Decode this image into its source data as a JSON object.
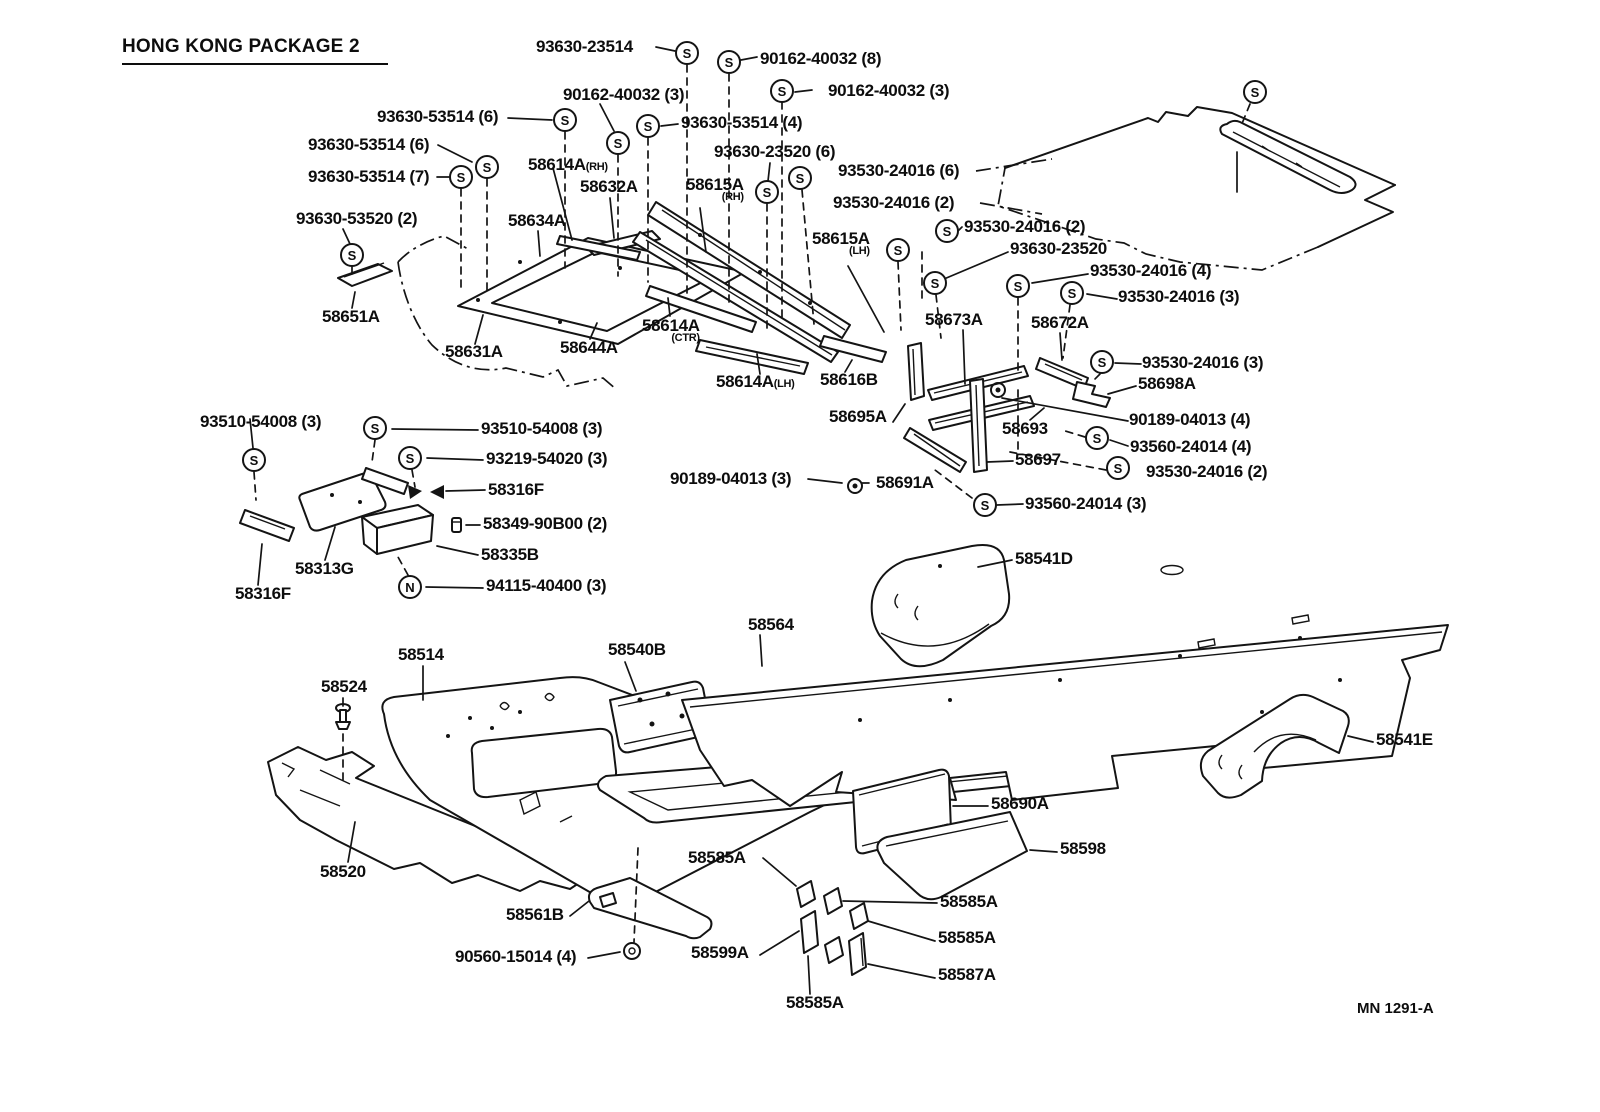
{
  "title": "HONG KONG PACKAGE 2",
  "drawing_number": "MN 1291-A",
  "colors": {
    "ink": "#141414",
    "background": "#ffffff"
  },
  "symbol_glyphs": {
    "screw": "S",
    "nut": "N"
  },
  "labels": [
    {
      "text": "93630-23514",
      "x": 536,
      "y": 38
    },
    {
      "text": "90162-40032 (8)",
      "x": 760,
      "y": 50
    },
    {
      "text": "90162-40032 (3)",
      "x": 563,
      "y": 86
    },
    {
      "text": "90162-40032 (3)",
      "x": 828,
      "y": 82
    },
    {
      "text": "93630-53514 (6)",
      "x": 377,
      "y": 108
    },
    {
      "text": "93630-53514 (4)",
      "x": 681,
      "y": 114
    },
    {
      "text": "93630-53514 (6)",
      "x": 308,
      "y": 136
    },
    {
      "text": "93630-23520 (6)",
      "x": 714,
      "y": 143
    },
    {
      "text": "93630-53514 (7)",
      "x": 308,
      "y": 168
    },
    {
      "text": "58614A",
      "x": 528,
      "y": 156,
      "sub": "(RH)",
      "subPos": "right"
    },
    {
      "text": "58632A",
      "x": 580,
      "y": 178
    },
    {
      "text": "93530-24016 (6)",
      "x": 838,
      "y": 162
    },
    {
      "text": "58615A",
      "x": 686,
      "y": 176,
      "sub": "(RH)",
      "subPos": "below"
    },
    {
      "text": "93530-24016 (2)",
      "x": 833,
      "y": 194
    },
    {
      "text": "93630-53520 (2)",
      "x": 296,
      "y": 210
    },
    {
      "text": "58634A",
      "x": 508,
      "y": 212
    },
    {
      "text": "93530-24016 (2)",
      "x": 964,
      "y": 218
    },
    {
      "text": "58615A",
      "x": 812,
      "y": 230,
      "sub": "(LH)",
      "subPos": "below"
    },
    {
      "text": "93630-23520",
      "x": 1010,
      "y": 240
    },
    {
      "text": "93530-24016 (4)",
      "x": 1090,
      "y": 262
    },
    {
      "text": "93530-24016 (3)",
      "x": 1118,
      "y": 288
    },
    {
      "text": "58651A",
      "x": 322,
      "y": 308
    },
    {
      "text": "58673A",
      "x": 925,
      "y": 311
    },
    {
      "text": "58672A",
      "x": 1031,
      "y": 314
    },
    {
      "text": "58631A",
      "x": 445,
      "y": 343
    },
    {
      "text": "58644A",
      "x": 560,
      "y": 339
    },
    {
      "text": "58614A",
      "x": 642,
      "y": 317,
      "sub": "(CTR)",
      "subPos": "below"
    },
    {
      "text": "93530-24016 (3)",
      "x": 1142,
      "y": 354
    },
    {
      "text": "58614A",
      "x": 716,
      "y": 373,
      "sub": "(LH)",
      "subPos": "right"
    },
    {
      "text": "58616B",
      "x": 820,
      "y": 371
    },
    {
      "text": "58698A",
      "x": 1138,
      "y": 375
    },
    {
      "text": "90189-04013 (4)",
      "x": 1129,
      "y": 411
    },
    {
      "text": "58695A",
      "x": 829,
      "y": 408
    },
    {
      "text": "58693",
      "x": 1002,
      "y": 420
    },
    {
      "text": "93560-24014 (4)",
      "x": 1130,
      "y": 438
    },
    {
      "text": "58697",
      "x": 1015,
      "y": 451
    },
    {
      "text": "93530-24016 (2)",
      "x": 1146,
      "y": 463
    },
    {
      "text": "90189-04013 (3)",
      "x": 670,
      "y": 470
    },
    {
      "text": "58691A",
      "x": 876,
      "y": 474
    },
    {
      "text": "93560-24014 (3)",
      "x": 1025,
      "y": 495
    },
    {
      "text": "93510-54008 (3)",
      "x": 200,
      "y": 413
    },
    {
      "text": "93510-54008 (3)",
      "x": 481,
      "y": 420
    },
    {
      "text": "93219-54020 (3)",
      "x": 486,
      "y": 450
    },
    {
      "text": "58316F",
      "x": 488,
      "y": 481
    },
    {
      "text": "58349-90B00 (2)",
      "x": 483,
      "y": 515
    },
    {
      "text": "58335B",
      "x": 481,
      "y": 546
    },
    {
      "text": "94115-40400 (3)",
      "x": 486,
      "y": 577
    },
    {
      "text": "58313G",
      "x": 295,
      "y": 560
    },
    {
      "text": "58316F",
      "x": 235,
      "y": 585
    },
    {
      "text": "58541D",
      "x": 1015,
      "y": 550
    },
    {
      "text": "58564",
      "x": 748,
      "y": 616
    },
    {
      "text": "58540B",
      "x": 608,
      "y": 641
    },
    {
      "text": "58514",
      "x": 398,
      "y": 646
    },
    {
      "text": "58524",
      "x": 321,
      "y": 678
    },
    {
      "text": "58541E",
      "x": 1376,
      "y": 731
    },
    {
      "text": "58690A",
      "x": 991,
      "y": 795
    },
    {
      "text": "58520",
      "x": 320,
      "y": 863
    },
    {
      "text": "58598",
      "x": 1060,
      "y": 840
    },
    {
      "text": "58585A",
      "x": 688,
      "y": 849
    },
    {
      "text": "58561B",
      "x": 506,
      "y": 906
    },
    {
      "text": "90560-15014 (4)",
      "x": 455,
      "y": 948
    },
    {
      "text": "58599A",
      "x": 691,
      "y": 944
    },
    {
      "text": "58585A",
      "x": 940,
      "y": 893
    },
    {
      "text": "58585A",
      "x": 938,
      "y": 929
    },
    {
      "text": "58587A",
      "x": 938,
      "y": 966
    },
    {
      "text": "58585A",
      "x": 786,
      "y": 994
    }
  ],
  "symbols": [
    {
      "glyph": "S",
      "x": 687,
      "y": 53
    },
    {
      "glyph": "S",
      "x": 729,
      "y": 62
    },
    {
      "glyph": "S",
      "x": 782,
      "y": 91
    },
    {
      "glyph": "S",
      "x": 565,
      "y": 120
    },
    {
      "glyph": "S",
      "x": 618,
      "y": 143
    },
    {
      "glyph": "S",
      "x": 648,
      "y": 126
    },
    {
      "glyph": "S",
      "x": 487,
      "y": 167
    },
    {
      "glyph": "S",
      "x": 461,
      "y": 177
    },
    {
      "glyph": "S",
      "x": 800,
      "y": 178
    },
    {
      "glyph": "S",
      "x": 767,
      "y": 192
    },
    {
      "glyph": "S",
      "x": 947,
      "y": 231
    },
    {
      "glyph": "S",
      "x": 898,
      "y": 250
    },
    {
      "glyph": "S",
      "x": 935,
      "y": 283
    },
    {
      "glyph": "S",
      "x": 1018,
      "y": 286
    },
    {
      "glyph": "S",
      "x": 1072,
      "y": 293
    },
    {
      "glyph": "S",
      "x": 1102,
      "y": 362
    },
    {
      "glyph": "S",
      "x": 1097,
      "y": 438
    },
    {
      "glyph": "S",
      "x": 1118,
      "y": 468
    },
    {
      "glyph": "S",
      "x": 985,
      "y": 505
    },
    {
      "glyph": "S",
      "x": 352,
      "y": 255
    },
    {
      "glyph": "S",
      "x": 254,
      "y": 460
    },
    {
      "glyph": "S",
      "x": 375,
      "y": 428
    },
    {
      "glyph": "S",
      "x": 410,
      "y": 458
    },
    {
      "glyph": "S",
      "x": 1255,
      "y": 92
    },
    {
      "glyph": "N",
      "x": 410,
      "y": 587
    }
  ]
}
